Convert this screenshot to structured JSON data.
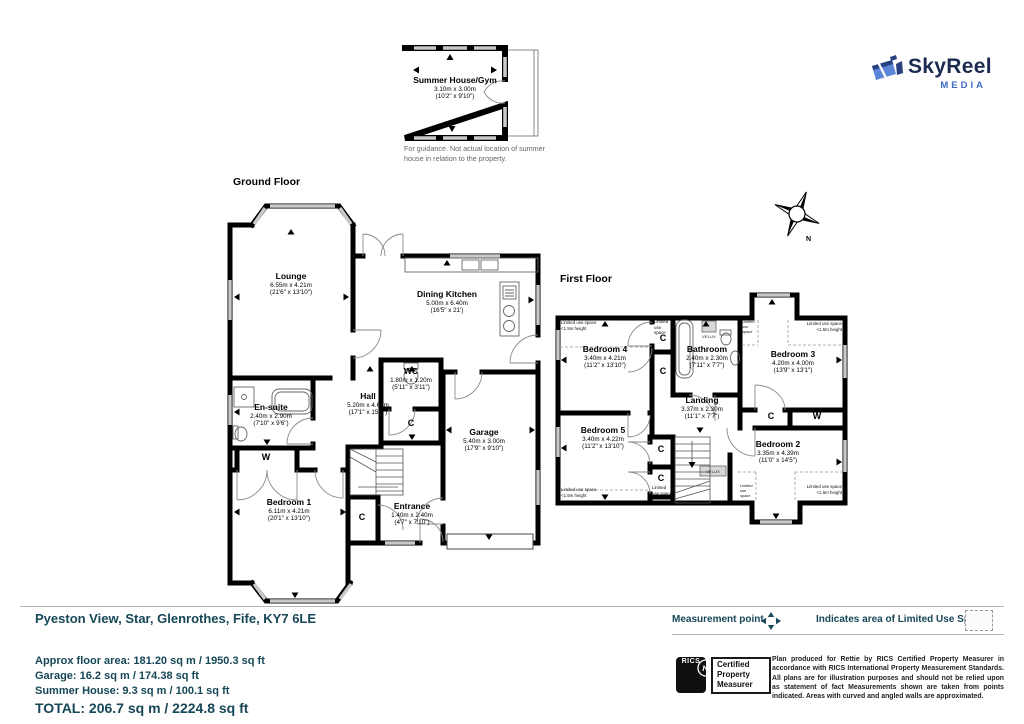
{
  "logo": {
    "name": "SkyReel",
    "sub": "MEDIA",
    "navy": "#1c2b50",
    "blue": "#3f6bc5"
  },
  "summer_house": {
    "room": {
      "name": "Summer House/Gym",
      "dims_m": "3.10m x 3.00m",
      "dims_ft": "(10'2\" x 9'10\")"
    },
    "note": "For guidance. Not actual location of summer house in relation to the property."
  },
  "ground_floor": {
    "title": "Ground Floor",
    "rooms": [
      {
        "name": "Lounge",
        "dims_m": "6.55m x 4.21m",
        "dims_ft": "(21'6\" x 13'10\")"
      },
      {
        "name": "Dining Kitchen",
        "dims_m": "5.00m x 6.40m",
        "dims_ft": "(16'5\" x 21')"
      },
      {
        "name": "WC",
        "dims_m": "1.80m x 1.20m",
        "dims_ft": "(5'11\" x 3'11\")"
      },
      {
        "name": "Hall",
        "dims_m": "5.20m x 4.61m",
        "dims_ft": "(17'1\" x 15'1\")"
      },
      {
        "name": "En-suite",
        "dims_m": "2.40m x 2.90m",
        "dims_ft": "(7'10\" x 9'6\")"
      },
      {
        "name": "Bedroom 1",
        "dims_m": "6.11m x 4.21m",
        "dims_ft": "(20'1\" x 13'10\")"
      },
      {
        "name": "Entrance",
        "dims_m": "1.40m x 2.40m",
        "dims_ft": "(4'7\" x 7'10\")"
      },
      {
        "name": "Garage",
        "dims_m": "5.40m x 3.00m",
        "dims_ft": "(17'9\" x 9'10\")"
      }
    ]
  },
  "first_floor": {
    "title": "First Floor",
    "rooms": [
      {
        "name": "Bedroom 4",
        "dims_m": "3.40m x 4.21m",
        "dims_ft": "(11'2\" x 13'10\")"
      },
      {
        "name": "Bathroom",
        "dims_m": "2.40m x 2.30m",
        "dims_ft": "(7'11\" x 7'7\")"
      },
      {
        "name": "Bedroom 3",
        "dims_m": "4.20m x 4.00m",
        "dims_ft": "(13'9\" x 13'1\")"
      },
      {
        "name": "Landing",
        "dims_m": "3.37m x 2.30m",
        "dims_ft": "(11'1\" x 7'7\")"
      },
      {
        "name": "Bedroom 5",
        "dims_m": "3.40m x 4.22m",
        "dims_ft": "(11'2\" x 13'10\")"
      },
      {
        "name": "Bedroom 2",
        "dims_m": "3.35m x 4.39m",
        "dims_ft": "(11'0\" x 14'5\")"
      }
    ],
    "limited_use": "Limited use space",
    "limited_height": "<1.5m height",
    "velux": "VELUX"
  },
  "plan_labels": {
    "c": "C",
    "w": "W"
  },
  "compass": {
    "north": "N"
  },
  "footer": {
    "address": "Pyeston View, Star, Glenrothes, Fife, KY7 6LE",
    "legend": {
      "measurement_point": "Measurement point",
      "limited_use": "Indicates area of  Limited Use Space"
    },
    "areas": [
      "Approx floor area: 181.20 sq m / 1950.3 sq ft",
      "Garage: 16.2 sq m / 174.38 sq ft",
      "Summer House: 9.3 sq m / 100.1 sq ft"
    ],
    "total": "TOTAL: 206.7 sq m / 2224.8 sq ft",
    "rics": {
      "label": "RICS",
      "cert_line1": "Certified",
      "cert_line2": "Property",
      "cert_line3": "Measurer"
    },
    "disclaimer": "Plan produced for Rettie by RICS Certified Property Measurer in accordance with RICS International Property Measurement Standards. All plans are for illustration purposes and should not be relied upon as statement of fact Measurements shown are taken from points indicated. Areas with curved and angled walls are approximated."
  },
  "colors": {
    "teal": "#164757",
    "wall": "#000000",
    "window": "#c9c9c9",
    "accent_blue": "#3f6bc5"
  }
}
